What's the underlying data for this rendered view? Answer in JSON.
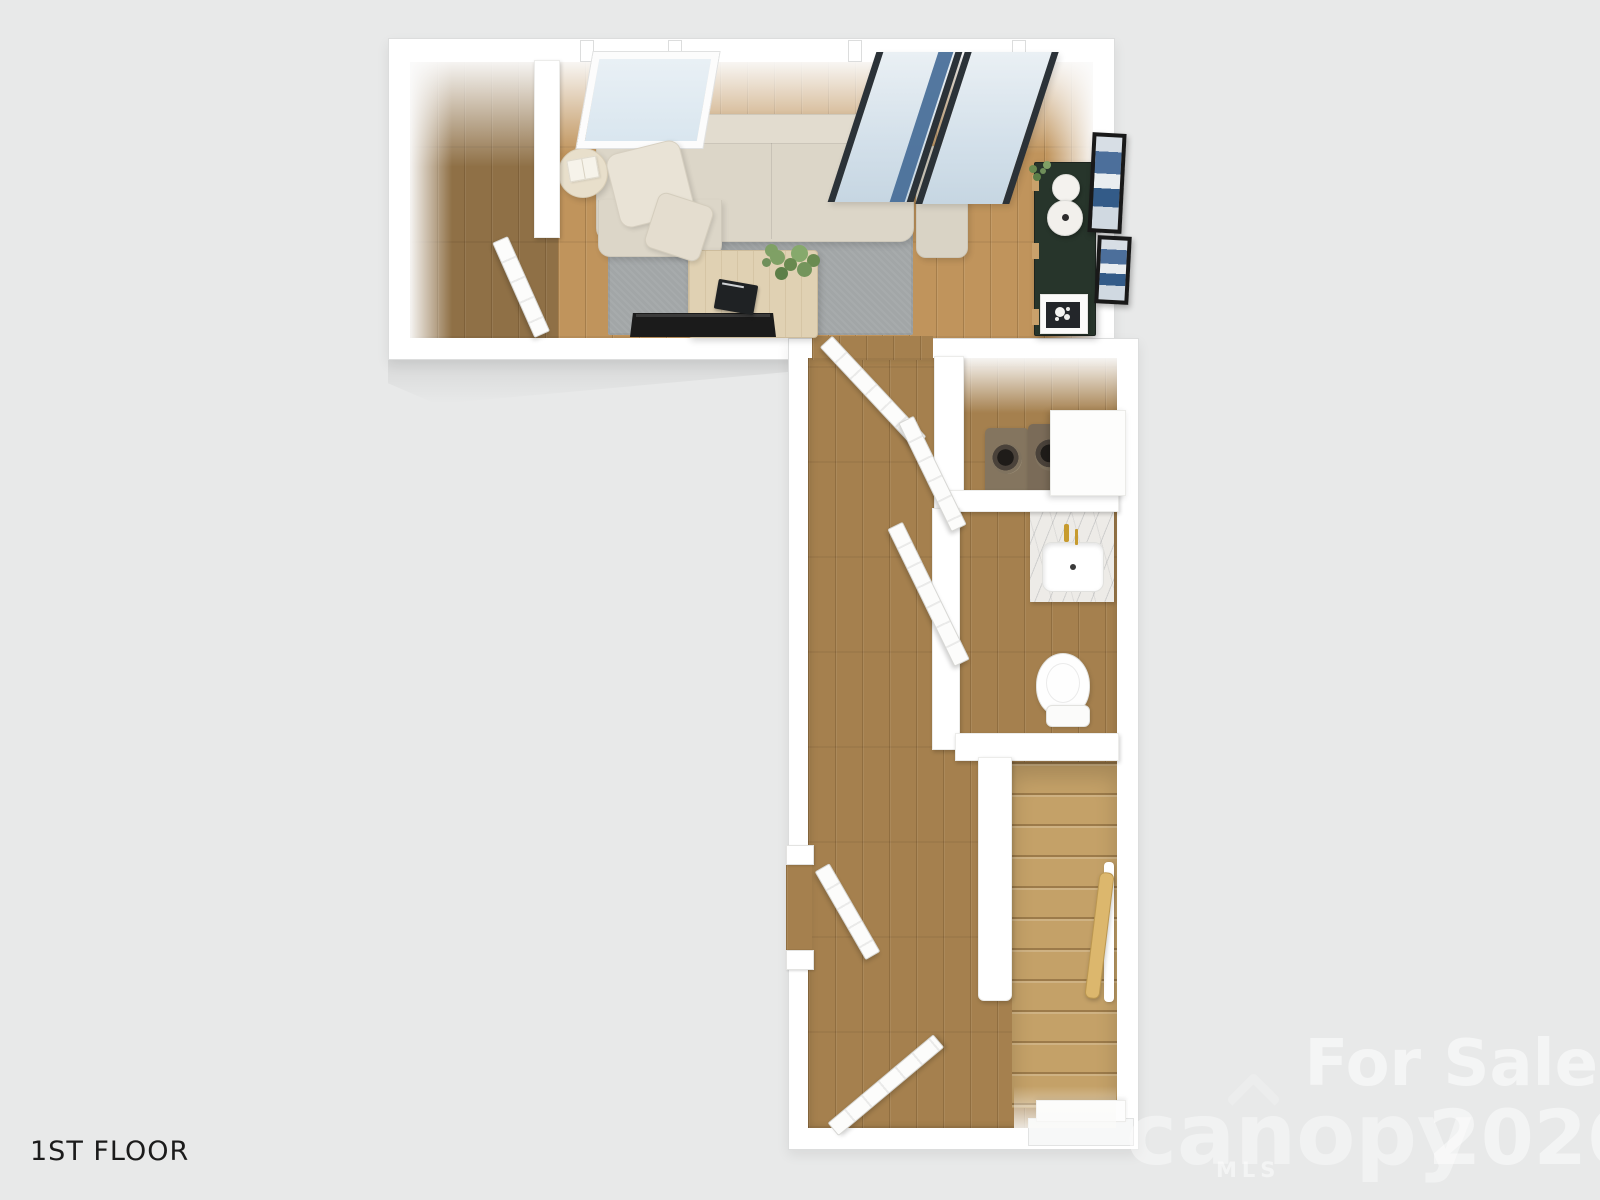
{
  "labels": {
    "floor_label": "1ST FLOOR"
  },
  "watermark": {
    "for_sale": "For Sale",
    "brand": "canopy",
    "brand_sub": "MLS",
    "year": "2026"
  },
  "colors": {
    "background": "#e8e9e9",
    "wall": "#ffffff",
    "wall_edge": "#dcdddd",
    "floor_living": "#c0945c",
    "floor_foyer": "#8f7046",
    "floor_hall": "#a5804e",
    "floor_stairs": "#c4a168",
    "rug": "#a2a6a7",
    "sofa": "#dcd6c8",
    "sofa_alt": "#d9d3c5",
    "pillow": "#e9e3d6",
    "table_wood": "#e0d1b3",
    "side_table": "#e8dfcb",
    "console": "#27352b",
    "console_leg": "#c9a16b",
    "tv": "#1b1b1b",
    "glass": "#d4e2ec",
    "glass_frame": "#2b3238",
    "glass_blue": "#3f6793",
    "art_frame": "#191919",
    "art_blue": "#4c6f9b",
    "marble": "#edebe7",
    "gold": "#c79b2e",
    "handrail": "#dcb76d",
    "appliance": "#84755f",
    "drum": "#2a2522",
    "label_text": "#1b1b1b",
    "watermark_white": "#ffffff"
  }
}
